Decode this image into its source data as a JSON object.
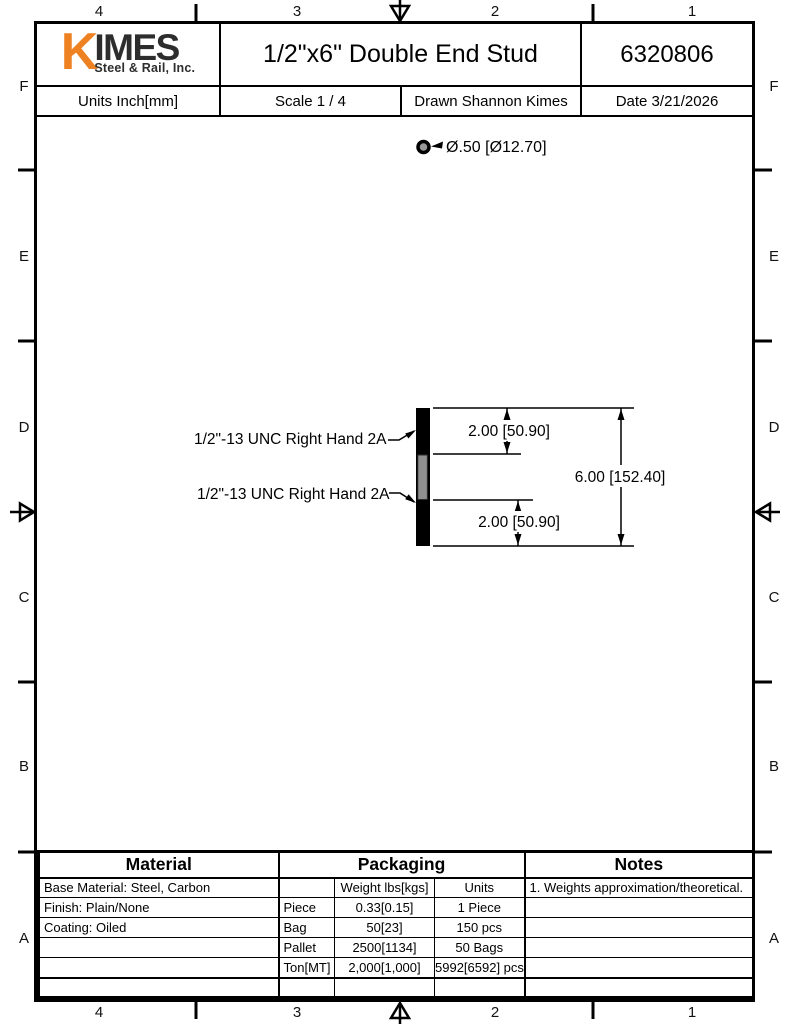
{
  "sheet": {
    "zones_top": [
      "4",
      "3",
      "2",
      "1"
    ],
    "zones_bottom": [
      "4",
      "3",
      "2",
      "1"
    ],
    "zones_left": [
      "F",
      "E",
      "D",
      "C",
      "B",
      "A"
    ],
    "zones_right": [
      "F",
      "E",
      "D",
      "C",
      "B",
      "A"
    ]
  },
  "title_block": {
    "logo_k": "K",
    "logo_imes": "IMES",
    "logo_subtitle": "Steel & Rail, Inc.",
    "title": "1/2\"x6\" Double End Stud",
    "part_number": "6320806",
    "units": "Units Inch[mm]",
    "scale": "Scale 1 / 4",
    "drawn": "Drawn Shannon Kimes",
    "date": "Date 3/21/2026"
  },
  "drawing": {
    "diameter_callout": "Ø.50 [Ø12.70]",
    "thread_callout_top": "1/2\"-13 UNC Right Hand 2A",
    "thread_callout_bottom": "1/2\"-13 UNC Right Hand 2A",
    "dim_top": "2.00 [50.90]",
    "dim_overall": "6.00 [152.40]",
    "dim_bottom": "2.00 [50.90]"
  },
  "colors": {
    "logo_orange": "#EE8122",
    "logo_dark": "#2D2D2D",
    "steel_gray": "#8F8F8F"
  },
  "material_table": {
    "header": "Material",
    "rows": [
      "Base Material: Steel, Carbon",
      "Finish: Plain/None",
      "Coating: Oiled"
    ]
  },
  "packaging_table": {
    "header": "Packaging",
    "col_weight": "Weight lbs[kgs]",
    "col_units": "Units",
    "rows": [
      {
        "label": "Piece",
        "weight": "0.33[0.15]",
        "units": "1 Piece"
      },
      {
        "label": "Bag",
        "weight": "50[23]",
        "units": "150 pcs"
      },
      {
        "label": "Pallet",
        "weight": "2500[1134]",
        "units": "50 Bags"
      },
      {
        "label": "Ton[MT]",
        "weight": "2,000[1,000]",
        "units": "5992[6592] pcs"
      }
    ]
  },
  "notes_table": {
    "header": "Notes",
    "note_1": "1. Weights approximation/theoretical."
  }
}
